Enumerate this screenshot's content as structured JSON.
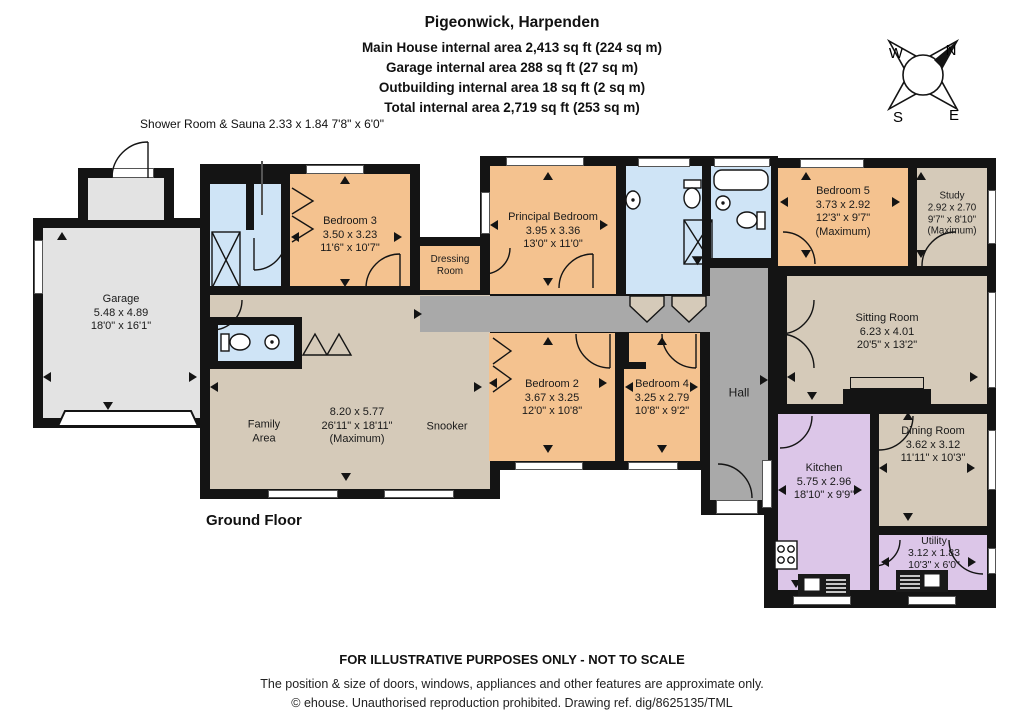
{
  "header": {
    "title": "Pigeonwick, Harpenden",
    "lines": [
      "Main House internal area 2,413 sq ft (224 sq m)",
      "Garage internal area 288 sq ft (27 sq m)",
      "Outbuilding internal area 18 sq ft (2 sq m)",
      "Total internal area 2,719 sq ft (253 sq m)"
    ]
  },
  "compass": {
    "north": "N",
    "east": "E",
    "south": "S",
    "west": "W"
  },
  "annotations": {
    "shower_room": {
      "name": "Shower Room & Sauna",
      "metric": "2.33 x 1.84",
      "imperial": "7'8\" x 6'0\""
    },
    "floor": "Ground Floor"
  },
  "rooms": {
    "garage": {
      "name": "Garage",
      "metric": "5.48 x 4.89",
      "imperial": "18'0\" x 16'1\""
    },
    "bedroom3": {
      "name": "Bedroom 3",
      "metric": "3.50 x 3.23",
      "imperial": "11'6\" x 10'7\""
    },
    "principal": {
      "name": "Principal Bedroom",
      "metric": "3.95 x 3.36",
      "imperial": "13'0\" x 11'0\""
    },
    "dressing": {
      "name": "Dressing Room"
    },
    "family": {
      "name": "Family Area",
      "metric": "8.20 x 5.77",
      "imperial": "26'11\" x 18'11\"",
      "note": "(Maximum)",
      "secondary": "Snooker"
    },
    "bedroom2": {
      "name": "Bedroom 2",
      "metric": "3.67 x 3.25",
      "imperial": "12'0\" x 10'8\""
    },
    "bedroom4": {
      "name": "Bedroom 4",
      "metric": "3.25 x 2.79",
      "imperial": "10'8\" x 9'2\""
    },
    "hall": {
      "name": "Hall"
    },
    "bedroom5": {
      "name": "Bedroom 5",
      "metric": "3.73 x 2.92",
      "imperial": "12'3\" x 9'7\"",
      "note": "(Maximum)"
    },
    "study": {
      "name": "Study",
      "metric": "2.92 x 2.70",
      "imperial": "9'7\" x 8'10\"",
      "note": "(Maximum)"
    },
    "sitting": {
      "name": "Sitting Room",
      "metric": "6.23 x 4.01",
      "imperial": "20'5\" x 13'2\""
    },
    "kitchen": {
      "name": "Kitchen",
      "metric": "5.75 x 2.96",
      "imperial": "18'10\" x 9'9\""
    },
    "dining": {
      "name": "Dining Room",
      "metric": "3.62 x 3.12",
      "imperial": "11'11\" x 10'3\""
    },
    "utility": {
      "name": "Utility",
      "metric": "3.12 x 1.83",
      "imperial": "10'3\" x 6'0\""
    }
  },
  "footer": {
    "line1": "FOR ILLUSTRATIVE PURPOSES ONLY - NOT TO SCALE",
    "line2": "The position & size of doors, windows, appliances and other features are approximate only.",
    "line3": "© ehouse. Unauthorised reproduction prohibited. Drawing ref. dig/8625135/TML"
  },
  "colors": {
    "wall": "#141414",
    "bedroom": "#f4c28f",
    "living": "#d5cab9",
    "bathroom": "#cfe4f6",
    "kitchen": "#dcc6e8",
    "hall": "#a9a9a9",
    "garage": "#e3e3e3"
  }
}
